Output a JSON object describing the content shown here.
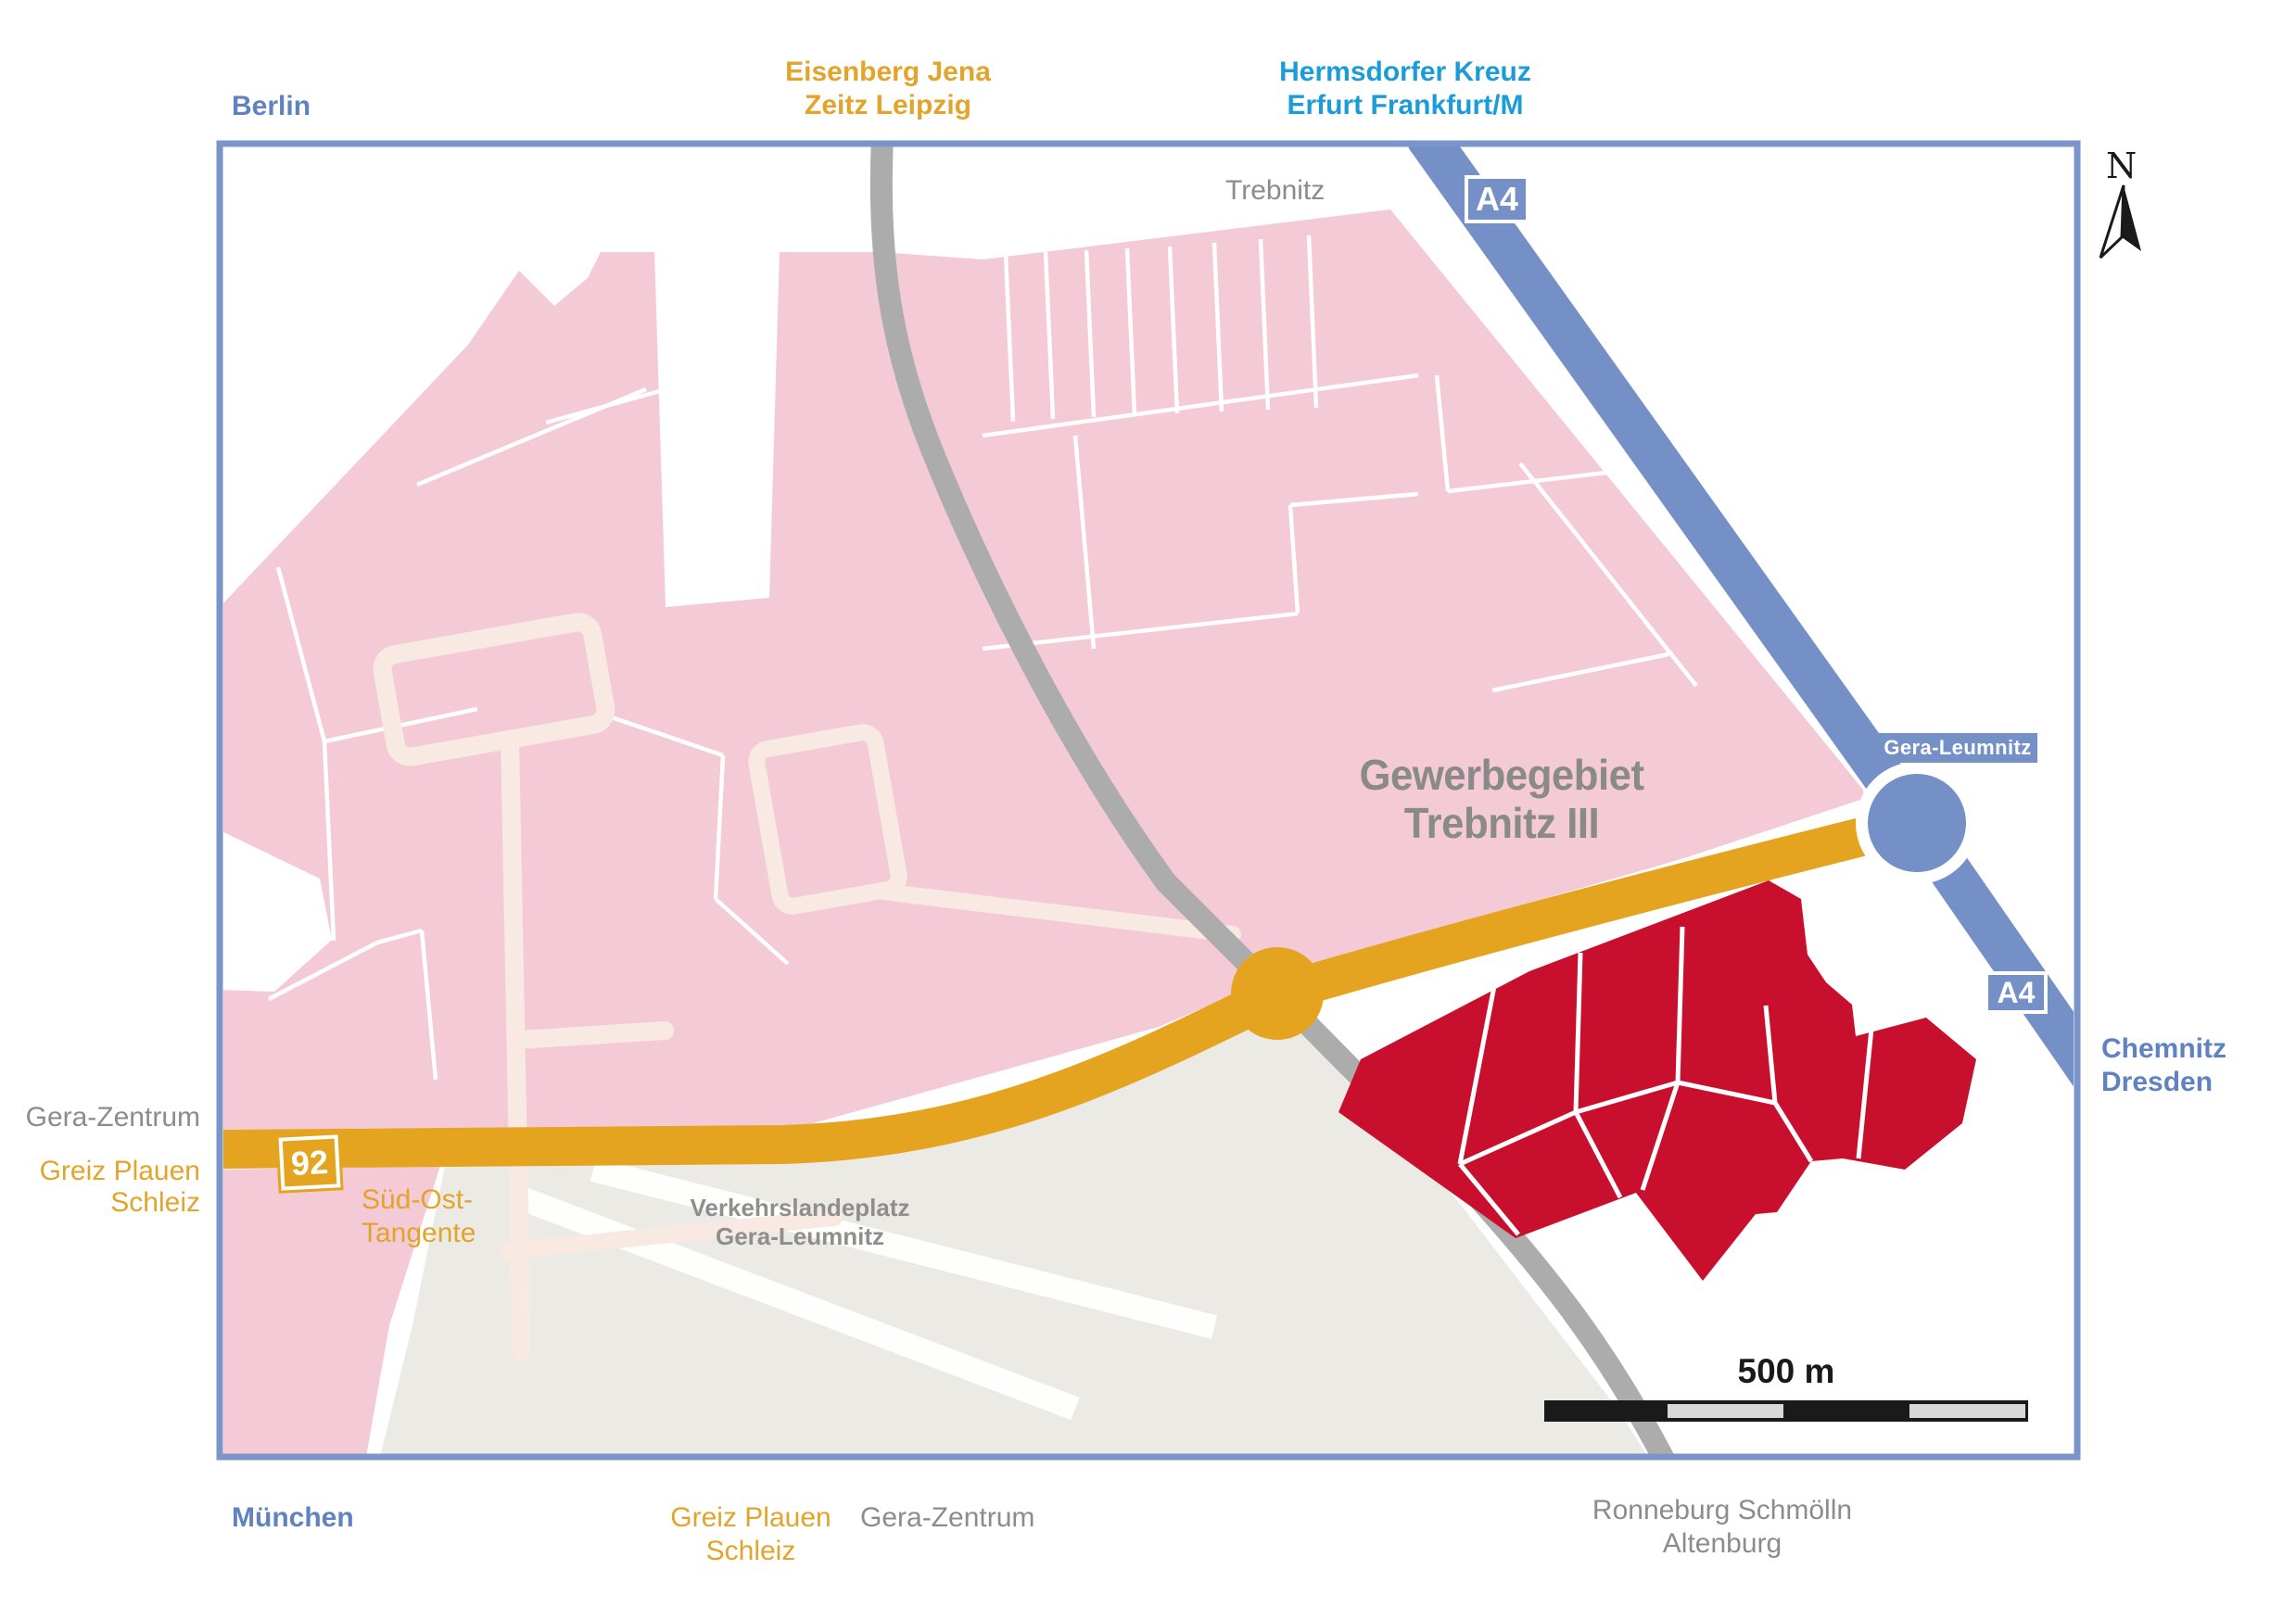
{
  "labels": {
    "berlin": "Berlin",
    "eisenberg_line1": "Eisenberg Jena",
    "eisenberg_line2": "Zeitz Leipzig",
    "hermsdorf_line1": "Hermsdorfer Kreuz",
    "hermsdorf_line2": "Erfurt Frankfurt/M",
    "trebnitz": "Trebnitz",
    "chemnitz_line1": "Chemnitz",
    "chemnitz_line2": "Dresden",
    "gera_zentrum_left": "Gera-Zentrum",
    "greiz_left_line1": "Greiz Plauen",
    "greiz_left_line2": "Schleiz",
    "sued_ost_line1": "Süd-Ost-",
    "sued_ost_line2": "Tangente",
    "airport_line1": "Verkehrslandeplatz",
    "airport_line2": "Gera-Leumnitz",
    "gewerbegebiet_line1": "Gewerbegebiet",
    "gewerbegebiet_line2": "Trebnitz III",
    "muenchen": "München",
    "greiz_bottom_line1": "Greiz Plauen",
    "greiz_bottom_line2": "Schleiz",
    "gera_zentrum_bottom": "Gera-Zentrum",
    "ronneburg_line1": "Ronneburg Schmölln",
    "ronneburg_line2": "Altenburg"
  },
  "badges": {
    "a4_top": "A4",
    "a4_exit": "A4",
    "b92": "92",
    "junction_gera_leumnitz": "Gera-Leumnitz"
  },
  "scale_bar": {
    "label": "500 m"
  },
  "compass": {
    "label": "N"
  },
  "colors": {
    "frame_blue": "#7B95CB",
    "motorway_blue": "#7590C6",
    "city_label_blue": "#5F82C1",
    "motorway_label_cyan": "#199CD8",
    "road_yellow": "#E4A41F",
    "orange_text": "#E2A42A",
    "area_pink": "#F3CAD5",
    "minor_road_cream": "#F8E9E3",
    "site_red": "#C90F2E",
    "road_gray": "#ACACAC",
    "airport_gray": "#ECEAE5",
    "gray_text": "#8C8C8C",
    "dark_text": "#1A1A1A",
    "scalebar_light": "#D8D8D8"
  }
}
